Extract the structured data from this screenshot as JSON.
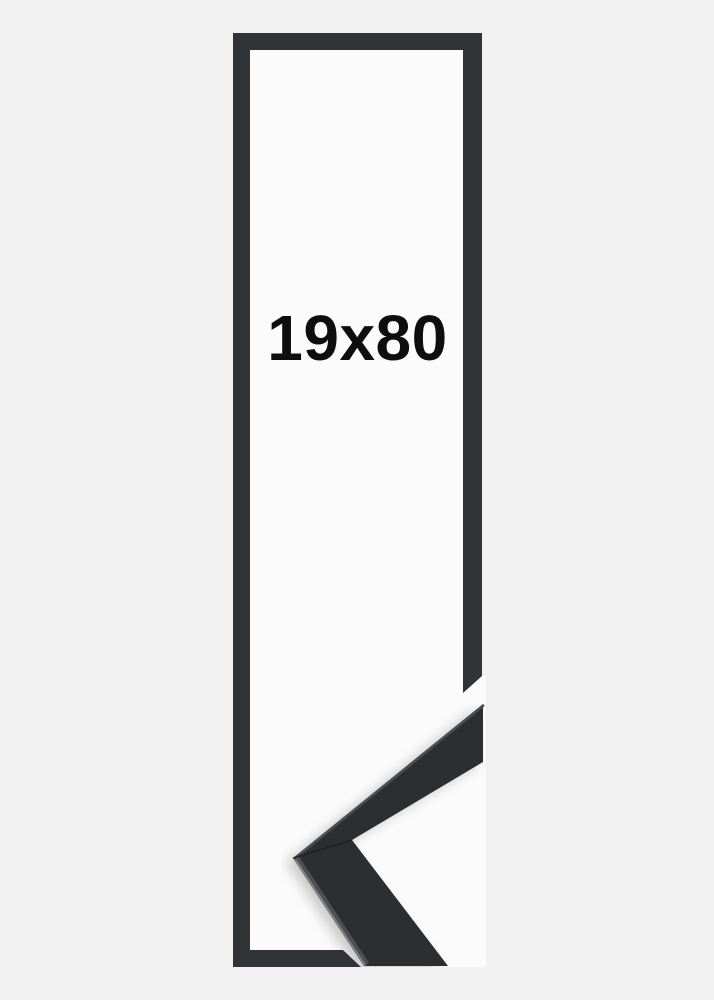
{
  "frame": {
    "size_label": "19x80"
  },
  "colors": {
    "page_background": "#f1f1f2",
    "frame_interior_white": "#fbfbfb",
    "frame_outline_dark": "#313437",
    "sample_moulding_dark": "#2c2e30",
    "sample_edge_highlight": "#808385",
    "label_text": "#0e0e0e"
  }
}
